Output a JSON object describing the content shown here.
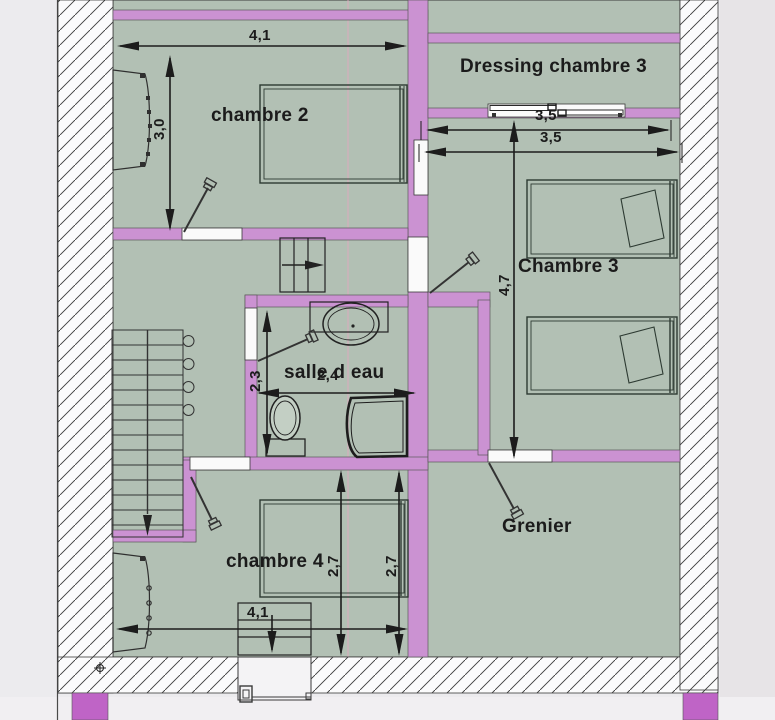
{
  "rooms": {
    "chambre2": "chambre 2",
    "dressing_chambre3": "Dressing chambre 3",
    "chambre3": "Chambre 3",
    "salle_d_eau": "salle d eau",
    "grenier": "Grenier",
    "chambre4": "chambre 4"
  },
  "dimensions": {
    "chambre2_width": "4,1",
    "chambre2_height": "3,0",
    "chambre3_width_upper": "3,5",
    "chambre3_width_lower": "3,5",
    "chambre3_height": "4,7",
    "salle_d_eau_height": "2,3",
    "salle_d_eau_width": "2,4",
    "chambre4_height_inner": "2,7",
    "chambre4_height_outer": "2,7",
    "chambre4_width": "4,1"
  },
  "icons": [
    "stairs-down-icon",
    "stairs-up-icon",
    "bed-icon",
    "wardrobe-icon",
    "sink-icon",
    "toilet-icon",
    "shower-icon",
    "door-swing-icon",
    "sliding-door-icon",
    "survey-mark-icon"
  ],
  "colors": {
    "wall": "#cb92d2",
    "wall_accent": "#bf64c6",
    "room_fill": "#b2c0b4",
    "line": "#2b2b2b",
    "paper": "#ecebee",
    "hatch_bg": "#fbfbfc"
  }
}
